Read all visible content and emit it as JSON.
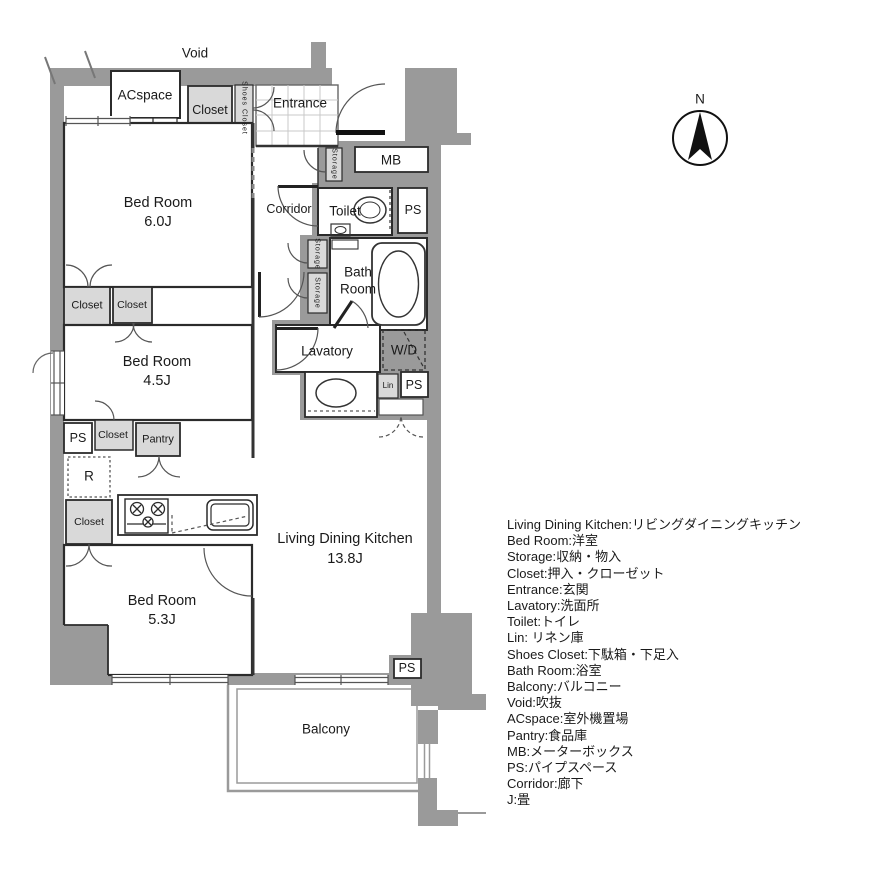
{
  "plan": {
    "labels": {
      "void": "Void",
      "acspace": "ACspace",
      "closet": "Closet",
      "shoes_closet": "Shoes Closet",
      "entrance": "Entrance",
      "mb": "MB",
      "storage": "Storage",
      "corridor": "Corridor",
      "toilet": "Toilet",
      "ps": "PS",
      "bath_line1": "Bath",
      "bath_line2": "Room",
      "lavatory": "Lavatory",
      "wd": "W/D",
      "lin": "Lin",
      "bed_room": "Bed Room",
      "bedroom1_size": "6.0J",
      "bedroom2_size": "4.5J",
      "bedroom3_size": "5.3J",
      "pantry": "Pantry",
      "refrigerator": "R",
      "ldk": "Living Dining Kitchen",
      "ldk_size": "13.8J",
      "balcony": "Balcony",
      "compass_north": "N"
    },
    "legend": {
      "lines": [
        "Living Dining Kitchen:リビングダイニングキッチン",
        "Bed Room:洋室",
        "Storage:収納・物入",
        "Closet:押入・クローゼット",
        "Entrance:玄関",
        "Lavatory:洗面所",
        "Toilet:トイレ",
        "Lin: リネン庫",
        "Shoes Closet:下駄箱・下足入",
        "Bath Room:浴室",
        "Balcony:バルコニー",
        "Void:吹抜",
        "ACspace:室外機置場",
        "Pantry:食品庫",
        "MB:メーターボックス",
        "PS:パイプスペース",
        "Corridor:廊下",
        "J:畳"
      ]
    },
    "colors": {
      "wall": "#9a9a9a",
      "storage_fill": "#d9d9d9",
      "line": "#2b2b2b",
      "background": "#ffffff"
    }
  }
}
